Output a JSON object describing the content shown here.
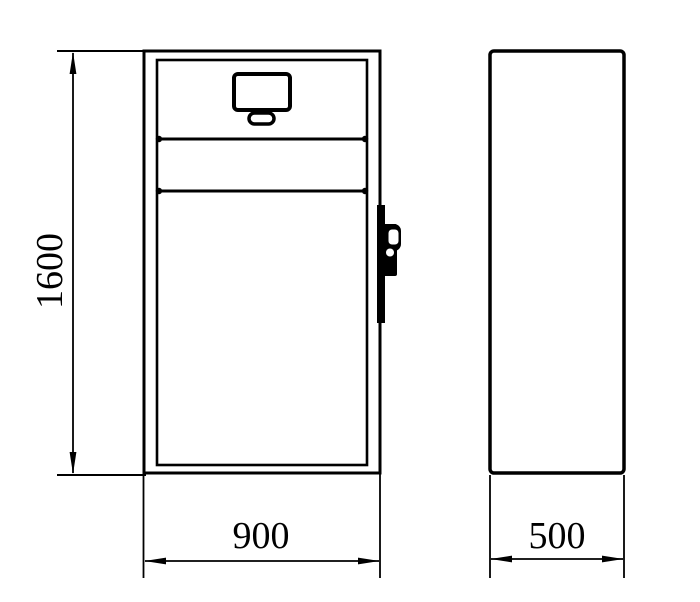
{
  "canvas": {
    "background": "#ffffff",
    "line_color": "#000000"
  },
  "drawing": {
    "kind": "engineering-orthographic-drawing",
    "views": {
      "front": {
        "name": "front-view",
        "features": {
          "display": "display-screen",
          "slot": "card-slot",
          "lock": "door-lock-handle",
          "band": "control-band"
        }
      },
      "side": {
        "name": "side-view"
      }
    },
    "dimensions": {
      "height": {
        "text": "1600",
        "orientation": "vertical"
      },
      "width": {
        "text": "900",
        "orientation": "horizontal"
      },
      "depth": {
        "text": "500",
        "orientation": "horizontal"
      }
    }
  }
}
